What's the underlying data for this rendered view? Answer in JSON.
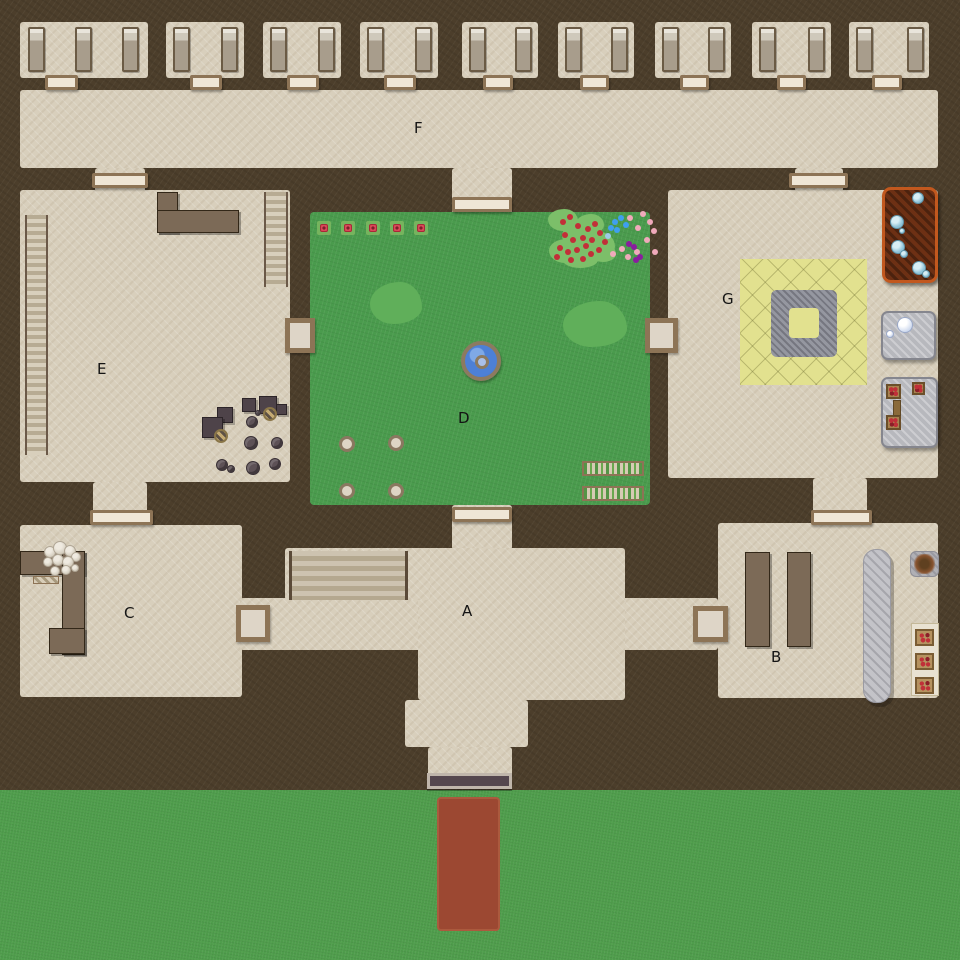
{
  "map": {
    "width": 960,
    "height": 960,
    "description": "top-down floor plan map of a walled complex with labeled areas A-G",
    "palette": {
      "wall": "#4c3e2b",
      "floor": "#d8cfbc",
      "courtyard_grass": "#4a9b4d",
      "field_grass": "#4f9d4c",
      "entry_path_red": "#9c4832",
      "door_fill": "#efe6d6",
      "door_frame": "#8d7456",
      "wood_brown": "#7c6a57",
      "fountain_water": "#4d80d6",
      "training_mat_yellow": "#e2e18f",
      "lounge_mat_brown": "#6d3014",
      "lounge_mat_border": "#c2581e",
      "plate_gray": "#b7b8bd",
      "label_color": "#141414"
    },
    "area_labels": [
      {
        "text": "A",
        "x": 462,
        "y": 604
      },
      {
        "text": "B",
        "x": 771,
        "y": 650
      },
      {
        "text": "C",
        "x": 124,
        "y": 606
      },
      {
        "text": "D",
        "x": 458,
        "y": 411
      },
      {
        "text": "E",
        "x": 97,
        "y": 362
      },
      {
        "text": "F",
        "x": 414,
        "y": 121
      },
      {
        "text": "G",
        "x": 722,
        "y": 292
      }
    ],
    "object_legend": [
      "bed-icon",
      "door-icon",
      "stairs-icon",
      "shelf-icon",
      "counter-icon",
      "table-icon",
      "stool-icon",
      "barrel-icon",
      "fountain-icon",
      "bush-icon",
      "rose-tile-icon",
      "flower-icon",
      "planter-icon",
      "stone-seat-icon",
      "training-mat-icon",
      "lounge-mat-icon",
      "water-bubble-icon",
      "plate-icon",
      "food-table-icon",
      "runner-rug-icon",
      "fire-pit-icon",
      "sack-icon",
      "gate-icon",
      "entry-path-icon"
    ],
    "field": {
      "x": 0,
      "y": 790,
      "w": 960,
      "h": 170
    },
    "entry_path": {
      "x": 437,
      "y": 797,
      "w": 63,
      "h": 134
    },
    "entry_gate": {
      "x": 427,
      "y": 773,
      "w": 85,
      "h": 16
    },
    "floors": [
      {
        "name": "corridor-f",
        "x": 20,
        "y": 90,
        "w": 918,
        "h": 78
      },
      {
        "name": "passage-f-to-e",
        "x": 95,
        "y": 168,
        "w": 50,
        "h": 24
      },
      {
        "name": "passage-f-to-g",
        "x": 795,
        "y": 168,
        "w": 48,
        "h": 24
      },
      {
        "name": "passage-f-to-d",
        "x": 452,
        "y": 168,
        "w": 60,
        "h": 46
      },
      {
        "name": "room-e",
        "x": 20,
        "y": 190,
        "w": 270,
        "h": 292
      },
      {
        "name": "room-g",
        "x": 668,
        "y": 190,
        "w": 270,
        "h": 288
      },
      {
        "name": "passage-e-to-c",
        "x": 93,
        "y": 482,
        "w": 54,
        "h": 45
      },
      {
        "name": "passage-g-to-b",
        "x": 813,
        "y": 478,
        "w": 54,
        "h": 47
      },
      {
        "name": "passage-d-to-a",
        "x": 452,
        "y": 505,
        "w": 60,
        "h": 45
      },
      {
        "name": "room-c",
        "x": 20,
        "y": 525,
        "w": 222,
        "h": 172
      },
      {
        "name": "room-b",
        "x": 718,
        "y": 523,
        "w": 220,
        "h": 175
      },
      {
        "name": "hall-a-band",
        "x": 240,
        "y": 598,
        "w": 478,
        "h": 52
      },
      {
        "name": "hall-a-body",
        "x": 418,
        "y": 548,
        "w": 207,
        "h": 152
      },
      {
        "name": "hall-a-stairs-block",
        "x": 285,
        "y": 548,
        "w": 145,
        "h": 52
      },
      {
        "name": "hall-a-entry-flare",
        "x": 405,
        "y": 700,
        "w": 123,
        "h": 47
      },
      {
        "name": "hall-a-entry-neck",
        "x": 428,
        "y": 747,
        "w": 84,
        "h": 30
      }
    ],
    "dorm": {
      "room_y": 22,
      "room_h": 56,
      "bed_y": 27,
      "bed_w": 17,
      "bed_h": 45,
      "door_y": 75,
      "door_h": 15,
      "rooms": [
        {
          "x": 20,
          "w": 128,
          "beds": [
            28,
            75,
            122
          ],
          "door_x": 45,
          "door_w": 33
        },
        {
          "x": 166,
          "w": 78,
          "beds": [
            173,
            221
          ],
          "door_x": 190,
          "door_w": 32
        },
        {
          "x": 263,
          "w": 78,
          "beds": [
            270,
            318
          ],
          "door_x": 287,
          "door_w": 32
        },
        {
          "x": 360,
          "w": 78,
          "beds": [
            367,
            415
          ],
          "door_x": 384,
          "door_w": 32
        },
        {
          "x": 462,
          "w": 76,
          "beds": [
            469,
            515
          ],
          "door_x": 483,
          "door_w": 30
        },
        {
          "x": 558,
          "w": 76,
          "beds": [
            565,
            611
          ],
          "door_x": 580,
          "door_w": 29
        },
        {
          "x": 655,
          "w": 76,
          "beds": [
            662,
            708
          ],
          "door_x": 680,
          "door_w": 29
        },
        {
          "x": 752,
          "w": 79,
          "beds": [
            759,
            808
          ],
          "door_x": 777,
          "door_w": 29
        },
        {
          "x": 849,
          "w": 80,
          "beds": [
            856,
            907
          ],
          "door_x": 872,
          "door_w": 30
        }
      ]
    },
    "doors_h": [
      {
        "name": "door-f-e",
        "x": 92,
        "y": 173,
        "w": 56
      },
      {
        "name": "door-f-g",
        "x": 789,
        "y": 173,
        "w": 59
      },
      {
        "name": "door-f-d",
        "x": 452,
        "y": 197,
        "w": 60
      },
      {
        "name": "door-d-a",
        "x": 452,
        "y": 507,
        "w": 60
      },
      {
        "name": "door-e-c",
        "x": 90,
        "y": 510,
        "w": 63
      },
      {
        "name": "door-g-b",
        "x": 811,
        "y": 510,
        "w": 61
      }
    ],
    "doors_sq": [
      {
        "name": "door-e-d",
        "x": 285,
        "y": 318,
        "w": 30,
        "h": 35
      },
      {
        "name": "door-d-g",
        "x": 645,
        "y": 318,
        "w": 33,
        "h": 35
      },
      {
        "name": "door-c-a",
        "x": 236,
        "y": 605,
        "w": 34,
        "h": 37
      },
      {
        "name": "door-a-b",
        "x": 693,
        "y": 606,
        "w": 35,
        "h": 36
      }
    ],
    "courtyard": {
      "x": 310,
      "y": 212,
      "w": 340,
      "h": 293,
      "rose_y": 221,
      "rose_tiles": [
        317,
        341,
        366,
        390,
        414
      ],
      "bushes": [
        [
          370,
          282,
          52,
          42
        ],
        [
          563,
          301,
          64,
          46
        ]
      ],
      "fountain": {
        "x": 461,
        "y": 341,
        "d": 40
      },
      "stones": [
        [
          339,
          436
        ],
        [
          388,
          435
        ],
        [
          339,
          483
        ],
        [
          388,
          483
        ]
      ],
      "stone_d": 16,
      "planters": [
        [
          582,
          461,
          62,
          15
        ],
        [
          582,
          486,
          62,
          15
        ]
      ],
      "garden_blobs": [
        [
          548,
          209,
          30,
          22
        ],
        [
          562,
          222,
          42,
          28
        ],
        [
          549,
          239,
          32,
          24
        ],
        [
          576,
          214,
          28,
          20
        ],
        [
          581,
          232,
          34,
          26
        ],
        [
          562,
          250,
          36,
          18
        ],
        [
          590,
          244,
          26,
          18
        ]
      ],
      "dot_colors": [
        "#c22f38",
        "#f0aabb",
        "#3f9ff0",
        "#8a1d9e",
        "#9ecbe8"
      ],
      "garden_dots": [
        [
          563,
          222,
          0
        ],
        [
          570,
          217,
          0
        ],
        [
          578,
          226,
          0
        ],
        [
          565,
          235,
          0
        ],
        [
          573,
          240,
          0
        ],
        [
          583,
          238,
          0
        ],
        [
          560,
          248,
          0
        ],
        [
          568,
          252,
          0
        ],
        [
          577,
          250,
          0
        ],
        [
          586,
          246,
          0
        ],
        [
          592,
          240,
          0
        ],
        [
          588,
          229,
          0
        ],
        [
          595,
          224,
          0
        ],
        [
          600,
          233,
          0
        ],
        [
          591,
          254,
          0
        ],
        [
          599,
          250,
          0
        ],
        [
          583,
          259,
          0
        ],
        [
          571,
          260,
          0
        ],
        [
          557,
          257,
          0
        ],
        [
          605,
          242,
          0
        ],
        [
          630,
          218,
          1
        ],
        [
          643,
          214,
          1
        ],
        [
          650,
          222,
          1
        ],
        [
          638,
          228,
          1
        ],
        [
          654,
          231,
          1
        ],
        [
          647,
          240,
          1
        ],
        [
          622,
          249,
          1
        ],
        [
          637,
          252,
          1
        ],
        [
          628,
          257,
          1
        ],
        [
          613,
          254,
          1
        ],
        [
          655,
          252,
          1
        ],
        [
          615,
          222,
          2
        ],
        [
          621,
          218,
          2
        ],
        [
          626,
          225,
          2
        ],
        [
          611,
          228,
          2
        ],
        [
          617,
          230,
          2
        ],
        [
          629,
          244,
          3
        ],
        [
          634,
          247,
          3
        ],
        [
          640,
          257,
          3
        ],
        [
          636,
          260,
          3
        ],
        [
          608,
          236,
          4
        ]
      ]
    },
    "room_e": {
      "shelf": [
        25,
        215,
        23,
        240
      ],
      "stairs": [
        264,
        192,
        24,
        95
      ],
      "counter": [
        [
          157,
          192,
          21,
          41
        ],
        [
          157,
          210,
          82,
          23
        ]
      ],
      "tables": [
        [
          242,
          398,
          14
        ],
        [
          259,
          396,
          18
        ],
        [
          276,
          404,
          11
        ],
        [
          217,
          407,
          16
        ],
        [
          202,
          417,
          21
        ]
      ],
      "barrels": [
        [
          263,
          407,
          14
        ],
        [
          214,
          429,
          14
        ]
      ],
      "stools": [
        [
          246,
          416,
          12
        ],
        [
          255,
          410,
          6
        ],
        [
          244,
          436,
          14
        ],
        [
          271,
          437,
          12
        ],
        [
          216,
          459,
          12
        ],
        [
          227,
          465,
          8
        ],
        [
          246,
          461,
          14
        ],
        [
          269,
          458,
          12
        ]
      ]
    },
    "room_c": {
      "counter": [
        [
          20,
          551,
          65,
          24
        ],
        [
          62,
          551,
          23,
          104
        ],
        [
          49,
          628,
          36,
          26
        ]
      ],
      "sacks": [
        [
          44,
          546,
          12
        ],
        [
          53,
          541,
          14
        ],
        [
          64,
          545,
          12
        ],
        [
          71,
          552,
          10
        ],
        [
          43,
          557,
          10
        ],
        [
          52,
          554,
          12
        ],
        [
          62,
          556,
          12
        ],
        [
          50,
          566,
          10
        ],
        [
          61,
          565,
          10
        ],
        [
          71,
          564,
          8
        ]
      ],
      "mat": [
        33,
        576,
        26,
        8
      ]
    },
    "hall_a": {
      "stairs": [
        289,
        551,
        119,
        49
      ]
    },
    "room_b": {
      "tables": [
        [
          745,
          552,
          25,
          95
        ],
        [
          787,
          552,
          24,
          95
        ]
      ],
      "runner": [
        863,
        549,
        28,
        154
      ],
      "fire_mat": [
        910,
        551,
        29,
        26
      ],
      "tray": [
        911,
        623,
        28,
        73
      ],
      "plates": [
        [
          915,
          629
        ],
        [
          915,
          653
        ],
        [
          915,
          677
        ]
      ],
      "plate_w": 19,
      "plate_h": 17
    },
    "room_g": {
      "mat_yellow": [
        740,
        259,
        127,
        126
      ],
      "ring": [
        771,
        290,
        66,
        67
      ],
      "ring_hole": [
        18,
        18,
        30,
        30
      ],
      "mat_brown": [
        882,
        187,
        56,
        96
      ],
      "mat_bubbles": [
        [
          912,
          192,
          12
        ],
        [
          890,
          215,
          14
        ],
        [
          899,
          228,
          6
        ],
        [
          891,
          240,
          14
        ],
        [
          900,
          250,
          8
        ],
        [
          912,
          261,
          14
        ],
        [
          922,
          270,
          8
        ]
      ],
      "plate1": [
        881,
        311,
        55,
        49
      ],
      "plate1_bubbles": [
        [
          897,
          317,
          16
        ],
        [
          886,
          330,
          8
        ]
      ],
      "plate2": [
        881,
        377,
        57,
        71
      ],
      "food_tables": [
        [
          886,
          384,
          15,
          15
        ],
        [
          912,
          382,
          13,
          13
        ],
        [
          886,
          415,
          15,
          15
        ]
      ],
      "food_bar": [
        893,
        400,
        8,
        16
      ]
    }
  }
}
